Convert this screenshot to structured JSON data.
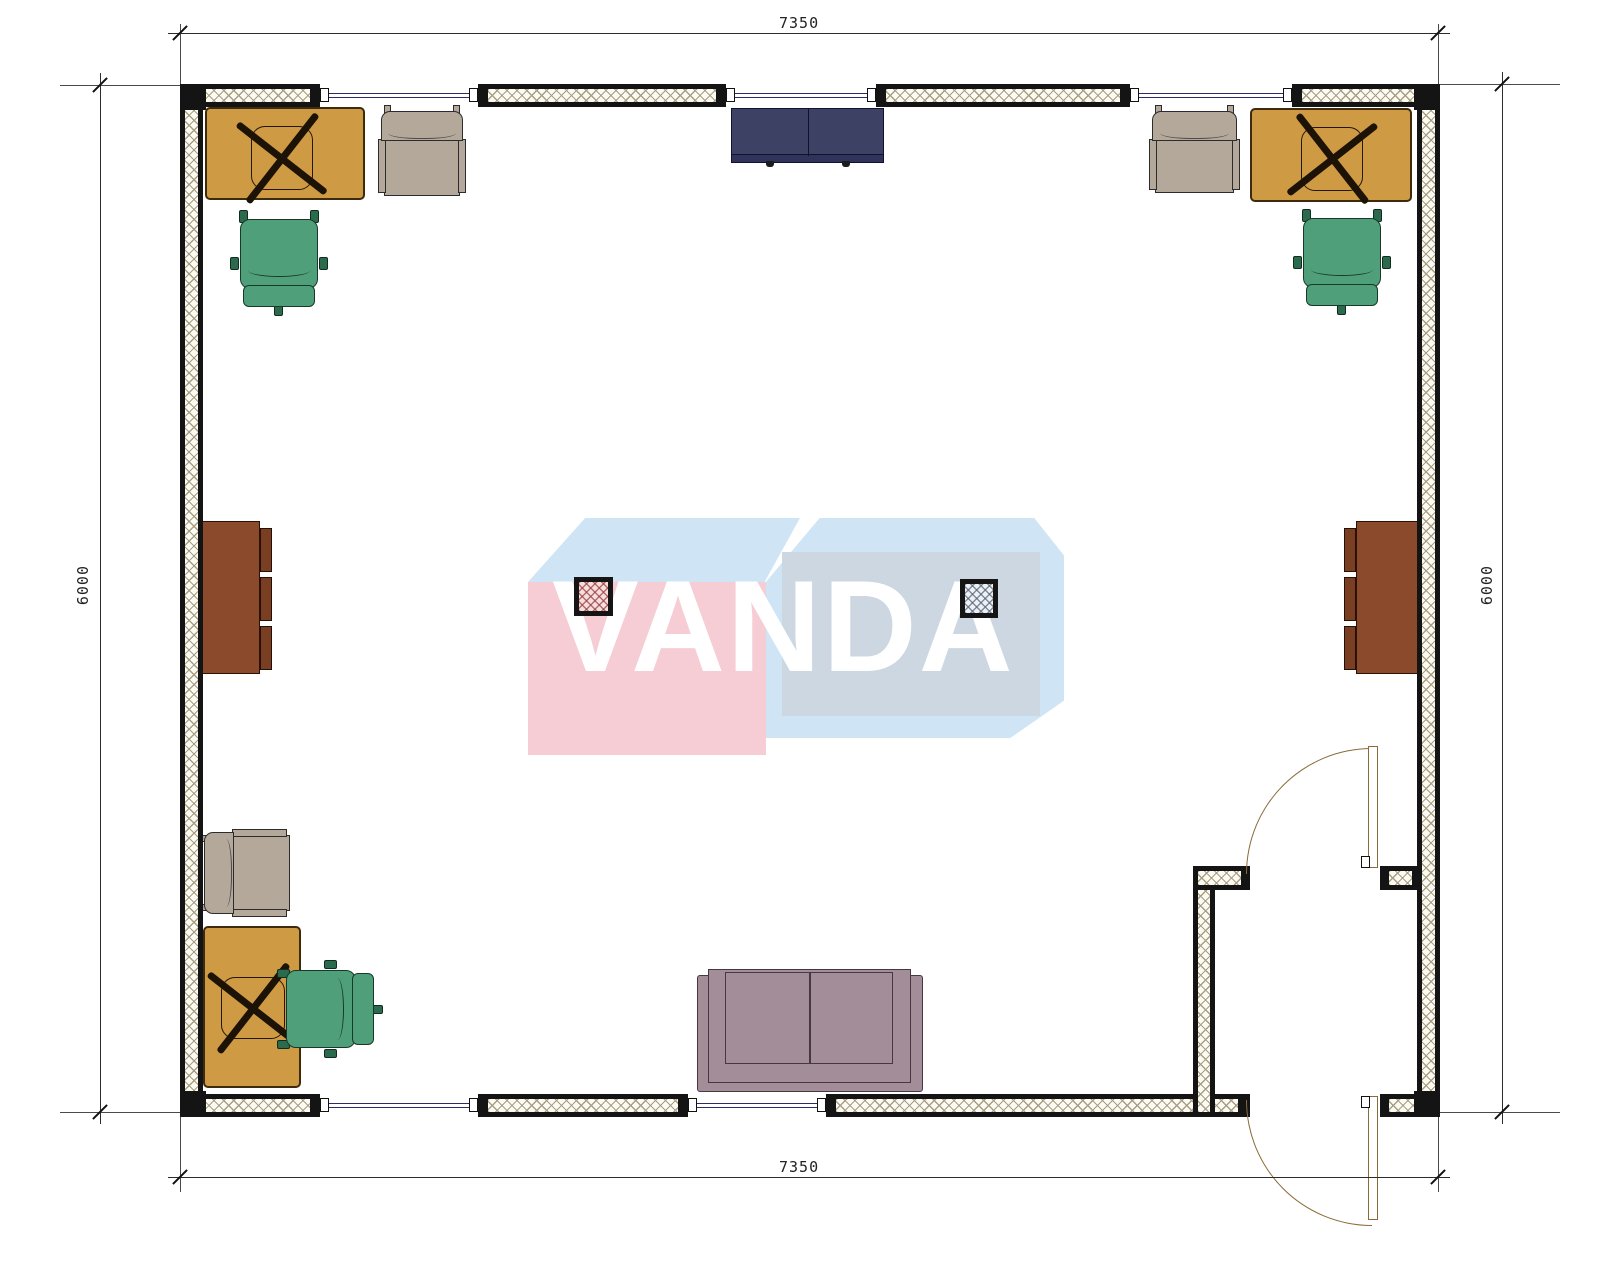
{
  "dimensions": {
    "top": "7350",
    "bottom": "7350",
    "left": "6000",
    "right": "6000"
  },
  "watermark": {
    "brand": "VANDA"
  },
  "palette": {
    "wall_black": "#141414",
    "hatch": "#a99e83",
    "window_line": "#2c2c6a",
    "desk_wood": "#cf9a44",
    "chair_beige": "#b4a89b",
    "chair_green": "#4f9f7b",
    "cabinet_navy": "#3d4164",
    "cabinet_brown": "#8a4a2b",
    "sofa_mauve": "#a28d99",
    "logo_pink": "#f6cdd5",
    "logo_blue": "#cfe5f5",
    "logo_gray_blue": "#cdd7e2",
    "door_line": "#8a6b3a"
  }
}
